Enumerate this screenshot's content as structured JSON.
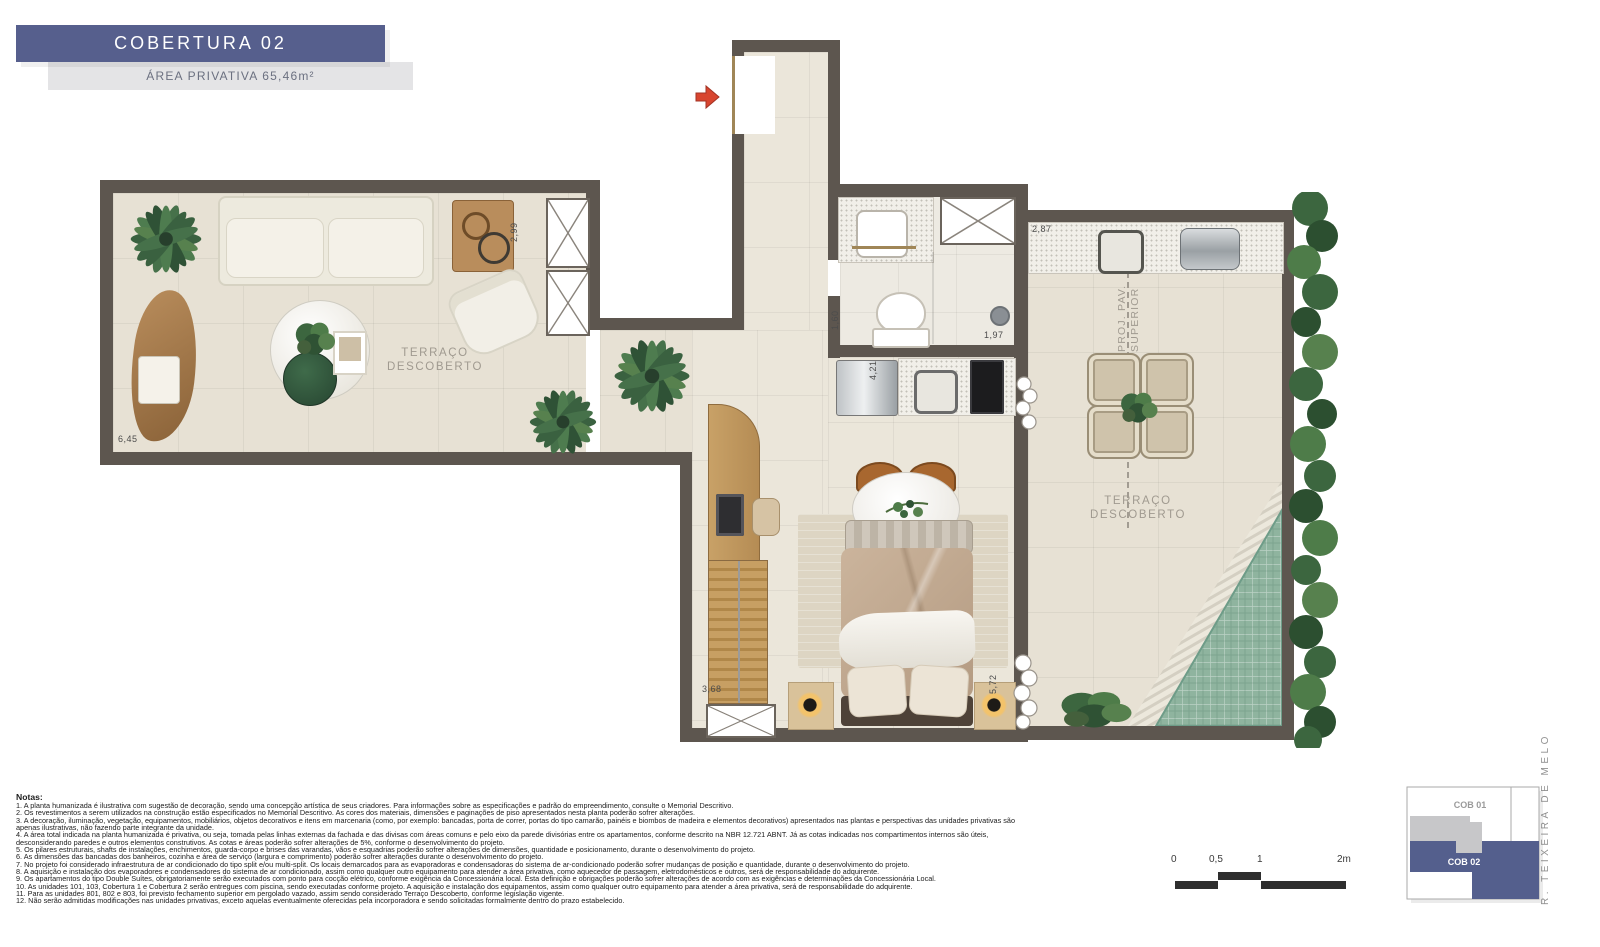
{
  "title": {
    "name": "COBERTURA 02",
    "area": "ÁREA PRIVATIVA 65,46m²"
  },
  "plan": {
    "labels": {
      "terrace_left_line1": "TERRAÇO",
      "terrace_left_line2": "DESCOBERTO",
      "terrace_right_line1": "TERRAÇO",
      "terrace_right_line2": "DESCOBERTO",
      "proj_line1": "PROJ. PAV.",
      "proj_line2": "SUPERIOR"
    },
    "dimensions": {
      "left_terrace_width": "6,45",
      "left_terrace_depth": "2,99",
      "bath_width": "1,60",
      "bath_length": "1,97",
      "kitchen_length": "4,21",
      "counter_length": "2,87",
      "right_terrace_depth": "5,72",
      "stairs_length": "3,68"
    }
  },
  "notes": {
    "heading": "Notas:",
    "items": [
      "1. A planta humanizada é ilustrativa com sugestão de decoração, sendo uma concepção artística de seus criadores. Para informações sobre as especificações e padrão do empreendimento, consulte o Memorial Descritivo.",
      "2. Os revestimentos a serem utilizados na construção estão especificados no Memorial Descritivo. As cores dos materiais, dimensões e paginações de piso apresentados nesta planta poderão sofrer alterações.",
      "3. A decoração, iluminação, vegetação, equipamentos, mobiliários, objetos decorativos e itens em marcenaria (como, por exemplo: bancadas, porta de correr, portas do tipo camarão, painéis e biombos de madeira e elementos decorativos) apresentados nas plantas e perspectivas das unidades privativas são apenas ilustrativas, não fazendo parte integrante da unidade.",
      "4. A área total indicada na planta humanizada é privativa, ou seja, tomada pelas linhas externas da fachada e das divisas com áreas comuns e pelo eixo da parede divisórias entre os apartamentos, conforme descrito na NBR 12.721 ABNT. Já as cotas indicadas nos compartimentos internos são úteis, desconsiderando paredes e outros elementos construtivos. As cotas e áreas poderão sofrer alterações de 5%, conforme o desenvolvimento do projeto.",
      "5. Os pilares estruturais, shafts de instalações, enchimentos, guarda-corpo e brises das varandas, vãos e esquadrias poderão sofrer alterações de dimensões, quantidade e posicionamento, durante o desenvolvimento do projeto.",
      "6. As dimensões das bancadas dos banheiros, cozinha e área de serviço (largura e comprimento) poderão sofrer alterações durante o desenvolvimento do projeto.",
      "7. No projeto foi considerado infraestrutura de ar condicionado do tipo split e/ou multi-split. Os locais demarcados para as evaporadoras e condensadoras do sistema de ar-condicionado poderão sofrer mudanças de posição e quantidade, durante o desenvolvimento do projeto.",
      "8. A aquisição e instalação dos evaporadores e condensadores do sistema de ar condicionado, assim como qualquer outro equipamento para atender a área privativa, como aquecedor de passagem, eletrodomésticos e outros, será de responsabilidade do adquirente.",
      "9. Os apartamentos do tipo Double Suítes, obrigatoriamente serão executados com ponto para cocção elétrico, conforme exigência da Concessionária local. Esta definição e obrigações poderão sofrer alterações de acordo com as exigências e determinações da Concessionária Local.",
      "10. As unidades 101, 103, Cobertura 1 e Cobertura 2 serão entregues com piscina, sendo executadas conforme projeto. A aquisição e instalação dos equipamentos, assim como qualquer outro equipamento para atender a área privativa, será de responsabilidade do adquirente.",
      "11. Para as unidades 801, 802 e 803, foi previsto fechamento superior em pergolado vazado, assim sendo considerado Terraço Descoberto, conforme legislação vigente.",
      "12. Não serão admitidas modificações nas unidades privativas, exceto aquelas eventualmente oferecidas pela incorporadora e sendo solicitadas formalmente dentro do prazo estabelecido."
    ]
  },
  "keyplan": {
    "cob01": "COB 01",
    "cob02": "COB 02",
    "street": "R. TEIXEIRA DE MELO"
  },
  "scalebar": {
    "t0": "0",
    "t05": "0,5",
    "t1": "1",
    "t2": "2m"
  },
  "colors": {
    "banner": "#565f8d",
    "wall": "#5d564f",
    "floor": "#e7e1d4",
    "pool": "#8fb49f",
    "hedge": "#3c663f",
    "entry_arrow": "#d8452f"
  },
  "icons": {
    "entry-arrow": "red right-pointing arrow (svg polygon)",
    "shaft-x-box": "white box with X cross (CSS gradients)",
    "palm-plant": "top-view palm leaves (svg ellipses)",
    "lamp": "radial glow circle"
  }
}
